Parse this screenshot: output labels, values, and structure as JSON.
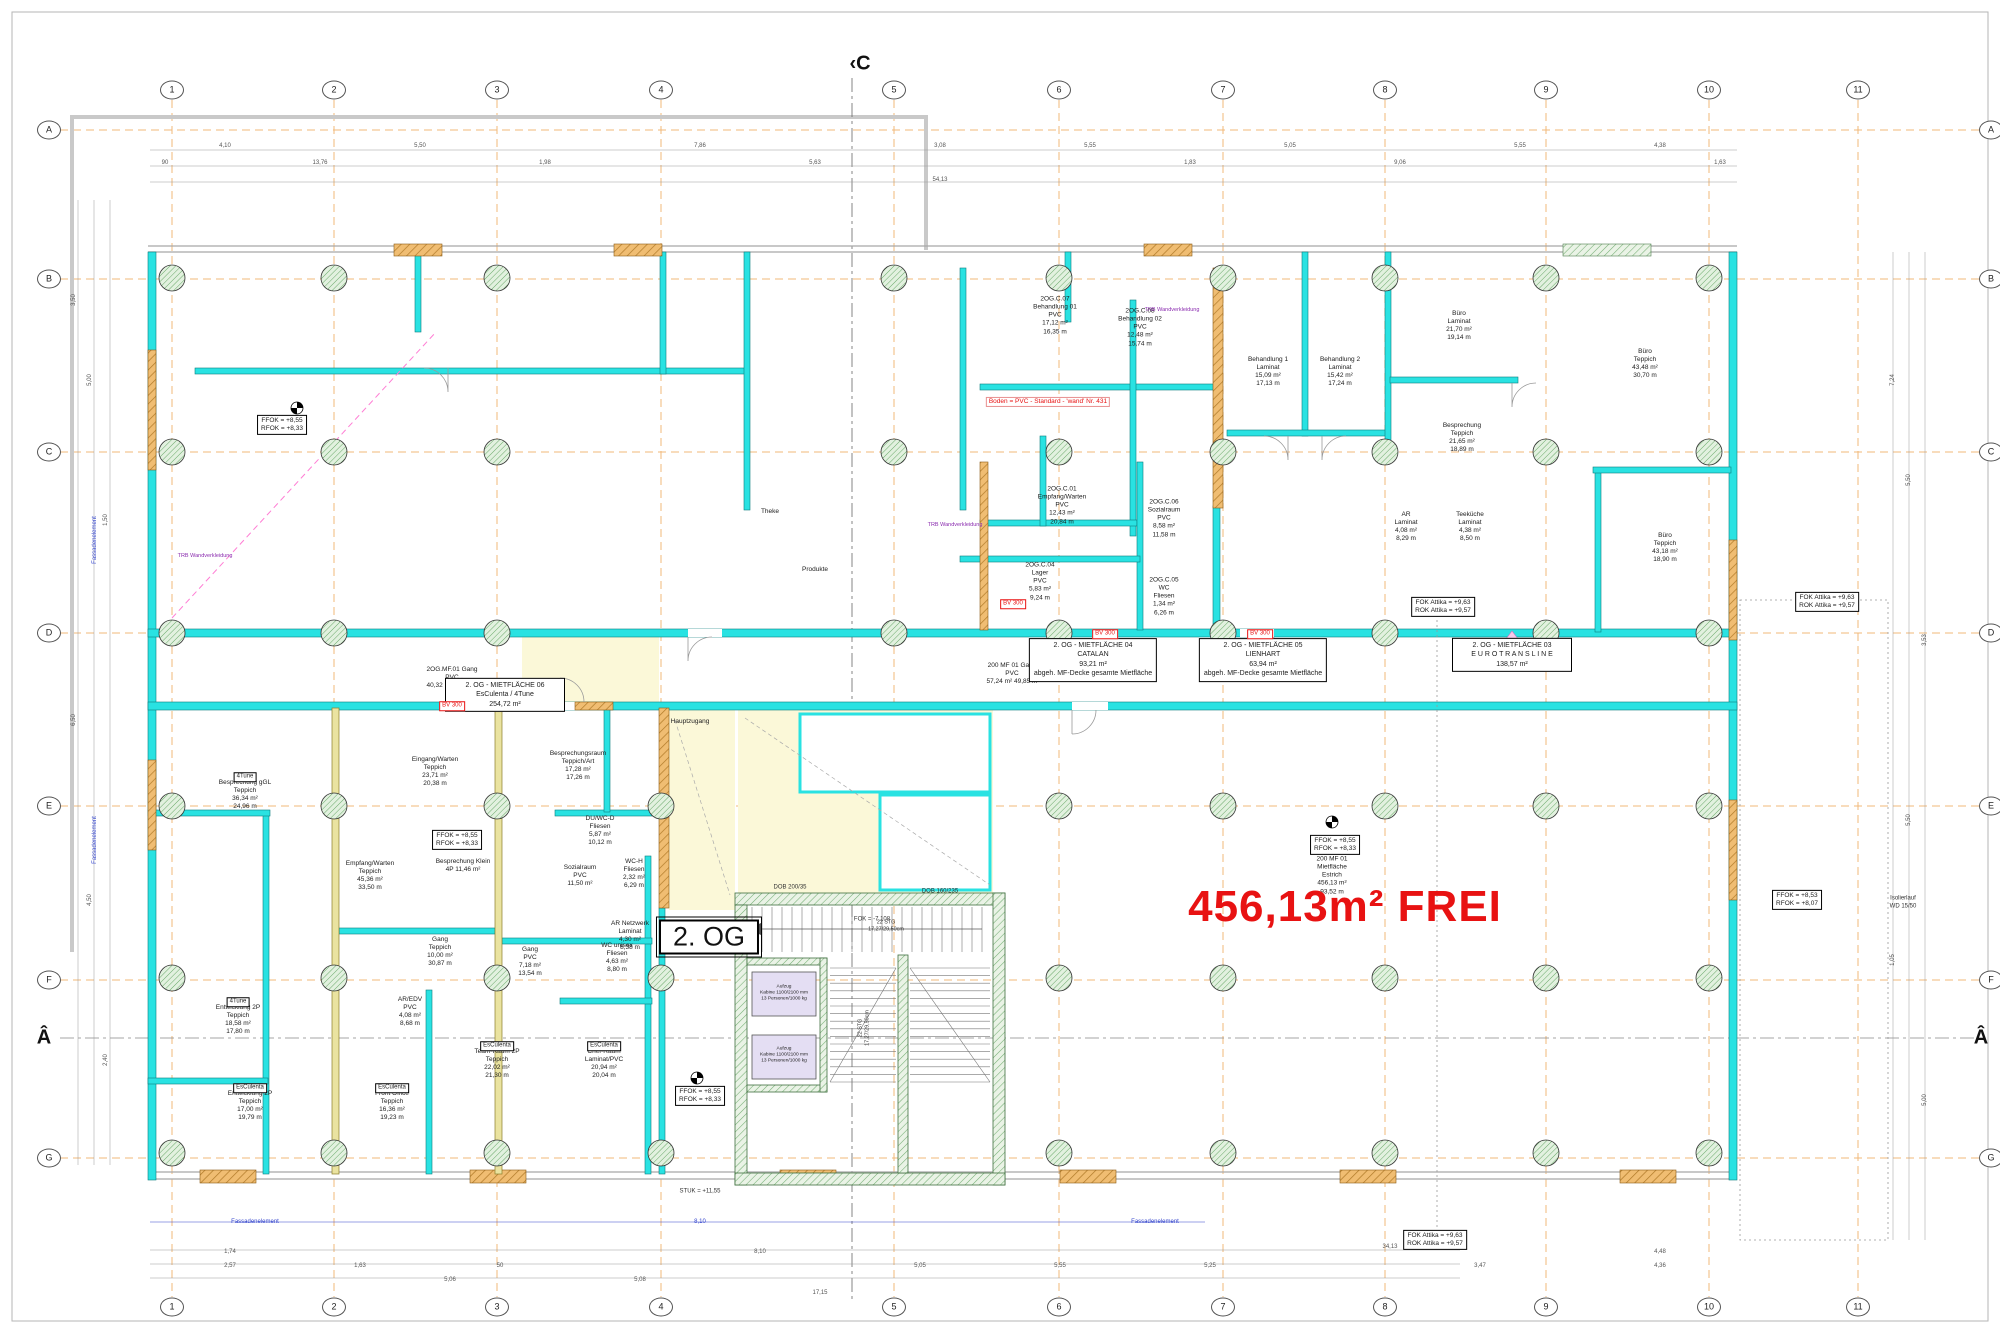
{
  "sheet": {
    "floor_label": "2. OG",
    "free_area_text": "456,13m² FREI",
    "icons": [
      "survey-point-icon",
      "grid-bubble",
      "section-marker",
      "column-symbol",
      "door-swing",
      "revision-triangle"
    ]
  },
  "colors": {
    "wall_cyan": "#29E2E2",
    "wall_tan": "#F0BD72",
    "wall_khaki": "#EAE3A0",
    "core_green": "#74AE74",
    "grid_orange": "#F2B878",
    "free_red": "#E81212",
    "zone_yellow": "#FBF8D8",
    "cabin_lavender": "#E4DEF3"
  },
  "grid": {
    "cols": [
      {
        "n": "1",
        "x": 172
      },
      {
        "n": "2",
        "x": 334
      },
      {
        "n": "3",
        "x": 497
      },
      {
        "n": "4",
        "x": 661
      },
      {
        "n": "5",
        "x": 894
      },
      {
        "n": "6",
        "x": 1059
      },
      {
        "n": "7",
        "x": 1223
      },
      {
        "n": "8",
        "x": 1385
      },
      {
        "n": "9",
        "x": 1546
      },
      {
        "n": "10",
        "x": 1709
      },
      {
        "n": "11",
        "x": 1858
      }
    ],
    "rows": [
      {
        "n": "A",
        "y": 130
      },
      {
        "n": "B",
        "y": 279
      },
      {
        "n": "C",
        "y": 452
      },
      {
        "n": "D",
        "y": 633
      },
      {
        "n": "E",
        "y": 806
      },
      {
        "n": "F",
        "y": 980
      },
      {
        "n": "G",
        "y": 1158
      }
    ],
    "top_y": 90,
    "bottom_y": 1307,
    "left_x": 49,
    "right_x": 1991
  },
  "section_markers": [
    {
      "t": "‹C",
      "x": 860,
      "y": 64
    },
    {
      "t": "Â",
      "x": 44,
      "y": 1038
    },
    {
      "t": "Â",
      "x": 1981,
      "y": 1038
    }
  ],
  "labels": {
    "rooms": [
      {
        "x": 1055,
        "y": 316,
        "lines": [
          "2OG.C.07",
          "Behandlung 01",
          "PVC",
          "17,12 m²",
          "16,35 m"
        ]
      },
      {
        "x": 1140,
        "y": 328,
        "lines": [
          "2OG.C.08",
          "Behandlung 02",
          "PVC",
          "12,48 m²",
          "15,74 m"
        ]
      },
      {
        "x": 1268,
        "y": 372,
        "lines": [
          "Behandlung 1",
          "Laminat",
          "15,09 m²",
          "17,13 m"
        ]
      },
      {
        "x": 1340,
        "y": 372,
        "lines": [
          "Behandlung 2",
          "Laminat",
          "15,42 m²",
          "17,24 m"
        ]
      },
      {
        "x": 1459,
        "y": 326,
        "lines": [
          "Büro",
          "Laminat",
          "21,70 m²",
          "19,14 m"
        ]
      },
      {
        "x": 1462,
        "y": 438,
        "lines": [
          "Besprechung",
          "Teppich",
          "21,65 m²",
          "18,89 m"
        ]
      },
      {
        "x": 1406,
        "y": 527,
        "lines": [
          "AR",
          "Laminat",
          "4,08 m²",
          "8,29 m"
        ]
      },
      {
        "x": 1470,
        "y": 527,
        "lines": [
          "Teeküche",
          "Laminat",
          "4,38 m²",
          "8,50 m"
        ]
      },
      {
        "x": 1645,
        "y": 364,
        "lines": [
          "Büro",
          "Teppich",
          "43,48 m²",
          "30,70 m"
        ]
      },
      {
        "x": 1665,
        "y": 548,
        "lines": [
          "Büro",
          "Teppich",
          "43,18 m²",
          "18,90 m"
        ]
      },
      {
        "x": 1062,
        "y": 506,
        "lines": [
          "2OG.C.01",
          "Empfang/Warten",
          "PVC",
          "12,43 m²",
          "20,84 m"
        ]
      },
      {
        "x": 1040,
        "y": 582,
        "lines": [
          "2OG.C.04",
          "Lager",
          "PVC",
          "5,83 m²",
          "9,24 m"
        ]
      },
      {
        "x": 1164,
        "y": 519,
        "lines": [
          "2OG.C.06",
          "Sozialraum",
          "PVC",
          "8,58 m²",
          "11,58 m"
        ]
      },
      {
        "x": 1164,
        "y": 597,
        "lines": [
          "2OG.C.05",
          "WC",
          "Fliesen",
          "1,34 m²",
          "6,26 m"
        ]
      },
      {
        "x": 770,
        "y": 512,
        "lines": [
          "Theke"
        ]
      },
      {
        "x": 815,
        "y": 570,
        "lines": [
          "Produkte"
        ]
      },
      {
        "x": 452,
        "y": 678,
        "lines": [
          "2OG.MF.01  Gang",
          "PVC",
          "40,32 m²  39,59 m"
        ]
      },
      {
        "x": 1012,
        "y": 674,
        "lines": [
          "200 MF 01  Gang",
          "PVC",
          "57,24 m²  49,85 m"
        ]
      },
      {
        "x": 435,
        "y": 772,
        "lines": [
          "Eingang/Warten",
          "Teppich",
          "23,71 m²",
          "20,38 m"
        ]
      },
      {
        "x": 578,
        "y": 766,
        "lines": [
          "Besprechungsraum",
          "Teppich/Art",
          "17,28 m²",
          "17,26 m"
        ]
      },
      {
        "x": 690,
        "y": 722,
        "lines": [
          "Hauptzugang"
        ]
      },
      {
        "x": 245,
        "y": 795,
        "lines": [
          "Besprechung gGL",
          "Teppich",
          "36,34 m²",
          "24,96 m"
        ]
      },
      {
        "x": 370,
        "y": 876,
        "lines": [
          "Empfang/Warten",
          "Teppich",
          "45,36 m²",
          "33,50 m"
        ]
      },
      {
        "x": 463,
        "y": 866,
        "lines": [
          "Besprechung Klein",
          "4P  11,46 m²"
        ]
      },
      {
        "x": 600,
        "y": 831,
        "lines": [
          "DU/WC-D",
          "Fliesen",
          "5,87 m²",
          "10,12 m"
        ]
      },
      {
        "x": 580,
        "y": 876,
        "lines": [
          "Sozialraum",
          "PVC",
          "11,50 m²"
        ]
      },
      {
        "x": 634,
        "y": 874,
        "lines": [
          "WC-H",
          "Fliesen",
          "2,32 m²",
          "6,29 m"
        ]
      },
      {
        "x": 440,
        "y": 952,
        "lines": [
          "Gang",
          "Teppich",
          "10,00 m²",
          "30,87 m"
        ]
      },
      {
        "x": 530,
        "y": 962,
        "lines": [
          "Gang",
          "PVC",
          "7,18 m²",
          "13,54 m"
        ]
      },
      {
        "x": 617,
        "y": 958,
        "lines": [
          "WC unisex",
          "Fliesen",
          "4,63 m²",
          "8,80 m"
        ]
      },
      {
        "x": 630,
        "y": 936,
        "lines": [
          "AR Netzwerk",
          "Laminat",
          "4,30 m²",
          "8,38 m"
        ]
      },
      {
        "x": 238,
        "y": 1020,
        "lines": [
          "Entwicklung 2P",
          "Teppich",
          "18,58 m²",
          "17,80 m"
        ]
      },
      {
        "x": 250,
        "y": 1106,
        "lines": [
          "Entwicklung 2P",
          "Teppich",
          "17,00 m²",
          "19,79 m"
        ]
      },
      {
        "x": 410,
        "y": 1012,
        "lines": [
          "AR/EDV",
          "PVC",
          "4,08 m²",
          "8,68 m"
        ]
      },
      {
        "x": 392,
        "y": 1106,
        "lines": [
          "Front Office",
          "Teppich",
          "16,36 m²",
          "19,23 m"
        ]
      },
      {
        "x": 497,
        "y": 1064,
        "lines": [
          "Team-Raum 2P",
          "Teppich",
          "22,02 m²",
          "21,30 m"
        ]
      },
      {
        "x": 604,
        "y": 1064,
        "lines": [
          "Chef-Raum",
          "Laminat/PVC",
          "20,94 m²",
          "20,04 m"
        ]
      },
      {
        "x": 1332,
        "y": 876,
        "lines": [
          "200 MF 01",
          "Mietfläche",
          "Estrich",
          "456,13 m²",
          "93,52 m"
        ]
      }
    ],
    "tenants": [
      {
        "x": 505,
        "y": 695,
        "lines": [
          "2. OG - MIETFLÄCHE 06",
          "EsCulenta / 4Tune",
          "254,72 m²"
        ]
      },
      {
        "x": 1093,
        "y": 660,
        "lines": [
          "2. OG - MIETFLÄCHE 04",
          "CATALAN",
          "93,21 m²",
          "abgeh. MF-Decke gesamte Mietfläche"
        ]
      },
      {
        "x": 1263,
        "y": 660,
        "lines": [
          "2. OG - MIETFLÄCHE 05",
          "LIENHART",
          "63,94 m²",
          "abgeh. MF-Decke gesamte Mietfläche"
        ]
      },
      {
        "x": 1512,
        "y": 655,
        "lines": [
          "2. OG - MIETFLÄCHE 03",
          "E U R O T R A N S L I N E",
          "138,57 m²"
        ]
      }
    ],
    "elev_boxes": [
      {
        "x": 282,
        "y": 425,
        "lines": [
          "FFOK = +8,55",
          "RFOK = +8,33"
        ]
      },
      {
        "x": 457,
        "y": 840,
        "lines": [
          "FFOK = +8,55",
          "RFOK = +8,33"
        ]
      },
      {
        "x": 700,
        "y": 1096,
        "lines": [
          "FFOK = +8,55",
          "RFOK = +8,33"
        ]
      },
      {
        "x": 1335,
        "y": 845,
        "lines": [
          "FFOK = +8,55",
          "RFOK = +8,33"
        ]
      },
      {
        "x": 1797,
        "y": 900,
        "lines": [
          "FFOK = +8,53",
          "RFOK = +8,07"
        ]
      }
    ],
    "attika_boxes": [
      {
        "x": 1827,
        "y": 602,
        "lines": [
          "FOK Attika = +9,63",
          "ROK Attika = +9,57"
        ]
      },
      {
        "x": 1443,
        "y": 607,
        "lines": [
          "FOK Attika = +9,63",
          "ROK Attika = +9,57"
        ]
      },
      {
        "x": 1435,
        "y": 1240,
        "lines": [
          "FOK Attika = +9,63",
          "ROK Attika = +9,57"
        ]
      }
    ],
    "tags": [
      {
        "t": "4Tune",
        "x": 245,
        "y": 777
      },
      {
        "t": "4Tune",
        "x": 238,
        "y": 1002
      },
      {
        "t": "EsCulenta",
        "x": 250,
        "y": 1088
      },
      {
        "t": "EsCulenta",
        "x": 392,
        "y": 1088
      },
      {
        "t": "EsCulenta",
        "x": 497,
        "y": 1046
      },
      {
        "t": "EsCulenta",
        "x": 604,
        "y": 1046
      }
    ],
    "red_tags": [
      {
        "t": "BV 300",
        "x": 452,
        "y": 706
      },
      {
        "t": "BV 300",
        "x": 1105,
        "y": 634
      },
      {
        "t": "BV 300",
        "x": 1260,
        "y": 634
      },
      {
        "t": "BV 300",
        "x": 1013,
        "y": 604
      }
    ],
    "misc": [
      {
        "x": 700,
        "y": 1192,
        "lines": [
          "STUK = +11,55"
        ]
      },
      {
        "x": 1903,
        "y": 903,
        "lines": [
          "Isolierlauf",
          "WD 15/50"
        ]
      },
      {
        "x": 872,
        "y": 920,
        "lines": [
          "FOK = -7,108"
        ]
      },
      {
        "x": 790,
        "y": 888,
        "lines": [
          "DOB 200/35"
        ]
      },
      {
        "x": 940,
        "y": 892,
        "lines": [
          "DOB 160/235"
        ]
      }
    ],
    "lift_labels": [
      {
        "x": 784,
        "y": 994,
        "lines": [
          "Aufzug",
          "Kabine 1100/2100 mm",
          "13 Personen/1000 kg"
        ]
      },
      {
        "x": 784,
        "y": 1056,
        "lines": [
          "Aufzug",
          "Kabine 1100/2100 mm",
          "13 Personen/1000 kg"
        ]
      }
    ],
    "stair_notes": [
      {
        "x": 886,
        "y": 926,
        "lines": [
          "22 STG",
          "17,27/29,50cm"
        ]
      },
      {
        "x": 864,
        "y": 1028,
        "r": -90,
        "lines": [
          "22 STG",
          "17,27/29,50cm"
        ]
      }
    ],
    "dims_top": [
      {
        "t": "4,10",
        "x": 225,
        "y": 146
      },
      {
        "t": "13,76",
        "x": 320,
        "y": 163
      },
      {
        "t": "90",
        "x": 165,
        "y": 163
      },
      {
        "t": "5,50",
        "x": 420,
        "y": 146
      },
      {
        "t": "1,98",
        "x": 545,
        "y": 163
      },
      {
        "t": "7,86",
        "x": 700,
        "y": 146
      },
      {
        "t": "5,63",
        "x": 815,
        "y": 163
      },
      {
        "t": "3,08",
        "x": 940,
        "y": 146
      },
      {
        "t": "54,13",
        "x": 940,
        "y": 180
      },
      {
        "t": "5,55",
        "x": 1090,
        "y": 146
      },
      {
        "t": "1,83",
        "x": 1190,
        "y": 163
      },
      {
        "t": "5,05",
        "x": 1290,
        "y": 146
      },
      {
        "t": "9,06",
        "x": 1400,
        "y": 163
      },
      {
        "t": "5,55",
        "x": 1520,
        "y": 146
      },
      {
        "t": "4,38",
        "x": 1660,
        "y": 146
      },
      {
        "t": "1,63",
        "x": 1720,
        "y": 163
      }
    ],
    "dims_bottom": [
      {
        "t": "1,74",
        "x": 230,
        "y": 1252
      },
      {
        "t": "2,57",
        "x": 230,
        "y": 1266
      },
      {
        "t": "1,63",
        "x": 360,
        "y": 1266
      },
      {
        "t": "5,06",
        "x": 450,
        "y": 1280
      },
      {
        "t": "50",
        "x": 500,
        "y": 1266
      },
      {
        "t": "5,08",
        "x": 640,
        "y": 1280
      },
      {
        "t": "8,10",
        "x": 760,
        "y": 1252
      },
      {
        "t": "17,15",
        "x": 820,
        "y": 1293
      },
      {
        "t": "5,05",
        "x": 920,
        "y": 1266
      },
      {
        "t": "5,55",
        "x": 1060,
        "y": 1266
      },
      {
        "t": "5,25",
        "x": 1210,
        "y": 1266
      },
      {
        "t": "34,13",
        "x": 1390,
        "y": 1247
      },
      {
        "t": "3,47",
        "x": 1480,
        "y": 1266
      },
      {
        "t": "4,48",
        "x": 1660,
        "y": 1252
      },
      {
        "t": "4,36",
        "x": 1660,
        "y": 1266
      }
    ],
    "dims_left": [
      {
        "t": "3,50",
        "x": 74,
        "y": 300,
        "r": -90
      },
      {
        "t": "5,00",
        "x": 90,
        "y": 380,
        "r": -90
      },
      {
        "t": "1,50",
        "x": 106,
        "y": 520,
        "r": -90
      },
      {
        "t": "6,50",
        "x": 74,
        "y": 720,
        "r": -90
      },
      {
        "t": "4,50",
        "x": 90,
        "y": 900,
        "r": -90
      },
      {
        "t": "2,40",
        "x": 106,
        "y": 1060,
        "r": -90
      }
    ],
    "dims_right": [
      {
        "t": "7,24",
        "x": 1893,
        "y": 380,
        "r": -90
      },
      {
        "t": "5,50",
        "x": 1909,
        "y": 480,
        "r": -90
      },
      {
        "t": "3,53",
        "x": 1925,
        "y": 640,
        "r": -90
      },
      {
        "t": "5,50",
        "x": 1909,
        "y": 820,
        "r": -90
      },
      {
        "t": "1,05",
        "x": 1893,
        "y": 960,
        "r": -90
      },
      {
        "t": "5,00",
        "x": 1925,
        "y": 1100,
        "r": -90
      }
    ],
    "blue_notes": [
      {
        "t": "Fassadenelement",
        "x": 255,
        "y": 1222
      },
      {
        "t": "Fassadenelement",
        "x": 1155,
        "y": 1222
      },
      {
        "t": "8,10",
        "x": 700,
        "y": 1222
      },
      {
        "t": "Fassadenelement",
        "x": 95,
        "y": 540,
        "r": -90
      },
      {
        "t": "Fassadenelement",
        "x": 95,
        "y": 840,
        "r": -90
      }
    ],
    "purple_notes": [
      {
        "t": "TRB Wandverkleidung",
        "x": 205,
        "y": 556
      },
      {
        "t": "TRB Wandverkleidung",
        "x": 1172,
        "y": 310
      },
      {
        "t": "TRB Wandverkleidung",
        "x": 955,
        "y": 525
      }
    ],
    "red_notes": [
      {
        "t": "Boden = PVC - Standard - 'wand' Nr. 431",
        "x": 1048,
        "y": 402
      }
    ]
  }
}
